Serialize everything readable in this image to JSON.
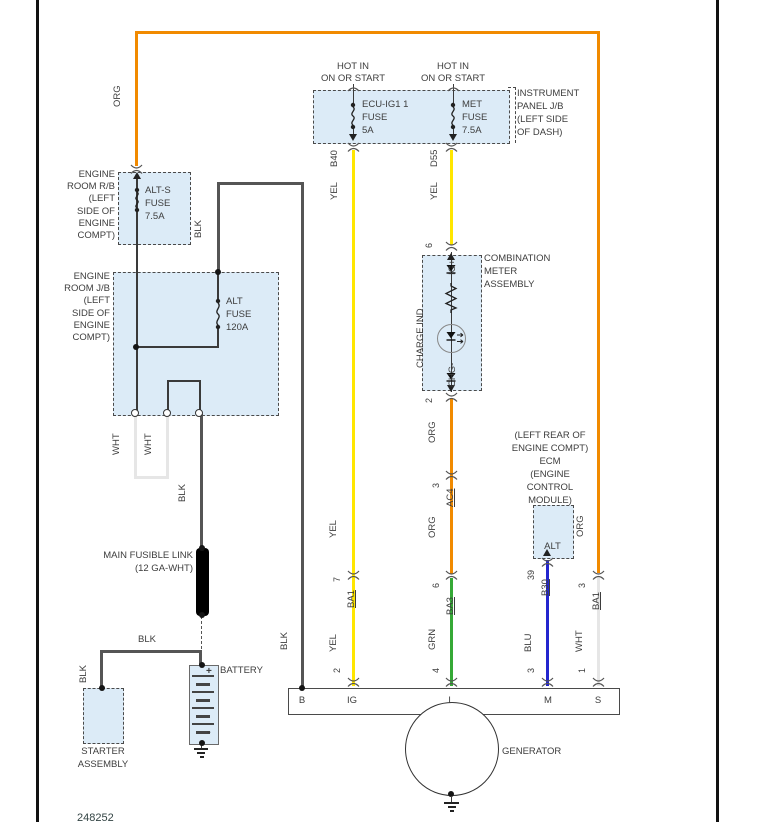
{
  "ref_number": "248252",
  "colors": {
    "wire_orange": "#F18A00",
    "wire_yellow": "#FFE600",
    "wire_green": "#35A936",
    "wire_blue": "#2326CE",
    "wire_white": "#E6E6E6",
    "wire_black": "#555555",
    "box_fill": "#DCEBF7",
    "box_border": "#4A4A4A"
  },
  "wire_names": {
    "org": "ORG",
    "yel": "YEL",
    "blk": "BLK",
    "wht": "WHT",
    "grn": "GRN",
    "blu": "BLU"
  },
  "hot_in": {
    "line1": "HOT IN",
    "line2": "ON OR START"
  },
  "instrument_panel": {
    "label": [
      "INSTRUMENT",
      "PANEL J/B",
      "(LEFT SIDE",
      "OF DASH)"
    ],
    "fuse_ecu_ig": [
      "ECU-IG1 1",
      "FUSE",
      "5A"
    ],
    "fuse_met": [
      "MET",
      "FUSE",
      "7.5A"
    ]
  },
  "engine_room_rb": {
    "label": [
      "ENGINE",
      "ROOM R/B",
      "(LEFT",
      "SIDE OF",
      "ENGINE",
      "COMPT)"
    ],
    "fuse": [
      "ALT-S",
      "FUSE",
      "7.5A"
    ]
  },
  "engine_room_jb": {
    "label": [
      "ENGINE",
      "ROOM J/B",
      "(LEFT",
      "SIDE OF",
      "ENGINE",
      "COMPT)"
    ],
    "fuse": [
      "ALT",
      "FUSE",
      "120A"
    ]
  },
  "combination_meter": {
    "label": [
      "COMBINATION",
      "METER",
      "ASSEMBLY"
    ],
    "charge_ind": "CHARGE IND",
    "ig_plus": "IG+",
    "chg_minus": "CHG-",
    "pin_top": "6",
    "pin_bottom": "2"
  },
  "ecm": {
    "label": [
      "(LEFT REAR OF",
      "ENGINE COMPT)",
      "ECM",
      "(ENGINE",
      "CONTROL",
      "MODULE)"
    ],
    "terminal": "ALT",
    "pin": "39",
    "connector": "B30"
  },
  "connectors": {
    "b40": "B40",
    "d55": "D55",
    "ba1_ig": {
      "pin": "7",
      "name": "BA1"
    },
    "ac4": {
      "pin": "3",
      "name": "AC4"
    },
    "ba3": {
      "pin": "6",
      "name": "BA3"
    },
    "ba1_s": {
      "pin": "3",
      "name": "BA1"
    }
  },
  "generator": {
    "label": "GENERATOR",
    "terminals": [
      "B",
      "IG",
      "L",
      "M",
      "S"
    ],
    "pins": {
      "ig": "2",
      "l": "4",
      "m": "3",
      "s": "1"
    }
  },
  "main_fusible_link": {
    "label": [
      "MAIN FUSIBLE LINK",
      "(12 GA-WHT)"
    ]
  },
  "battery": {
    "label": "BATTERY",
    "plus": "+",
    "minus": "-"
  },
  "starter": {
    "label": [
      "STARTER",
      "ASSEMBLY"
    ]
  }
}
